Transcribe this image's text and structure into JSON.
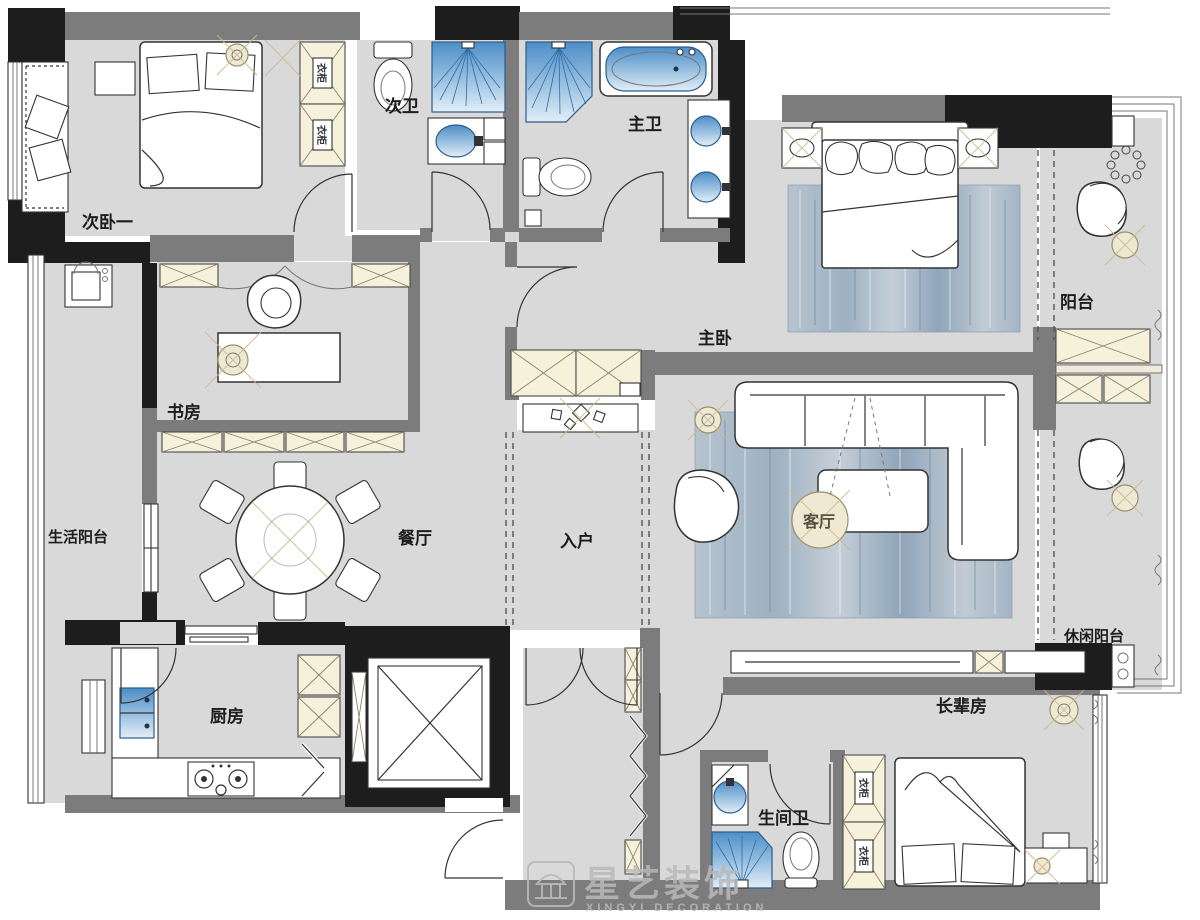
{
  "watermark": {
    "brand": "星艺装饰",
    "subtitle": "XINGYI DECORATION"
  },
  "rooms": {
    "bedroom2": "次卧一",
    "bath2": "次卫",
    "master_bath": "主卫",
    "master_bedroom": "主卧",
    "balcony": "阳台",
    "study": "书房",
    "service_balcony": "生活阳台",
    "dining": "餐厅",
    "entry": "入户",
    "living": "客厅",
    "leisure_balcony": "休闲阳台",
    "kitchen": "厨房",
    "elder_room": "长辈房",
    "elder_bath": "生间卫",
    "wardrobe": "衣柜"
  },
  "colors": {
    "wall_gray": "#7c7c7c",
    "structure_black": "#1d1d1d",
    "floor_gray": "#d9d9d9",
    "cabinet_cream": "#f6f1da",
    "fixture_blue": "#5b97cc",
    "rug_blue": "#a9bac9",
    "accent_beige": "#cfc3a0",
    "watermark_gray": "#b9b9b9"
  }
}
